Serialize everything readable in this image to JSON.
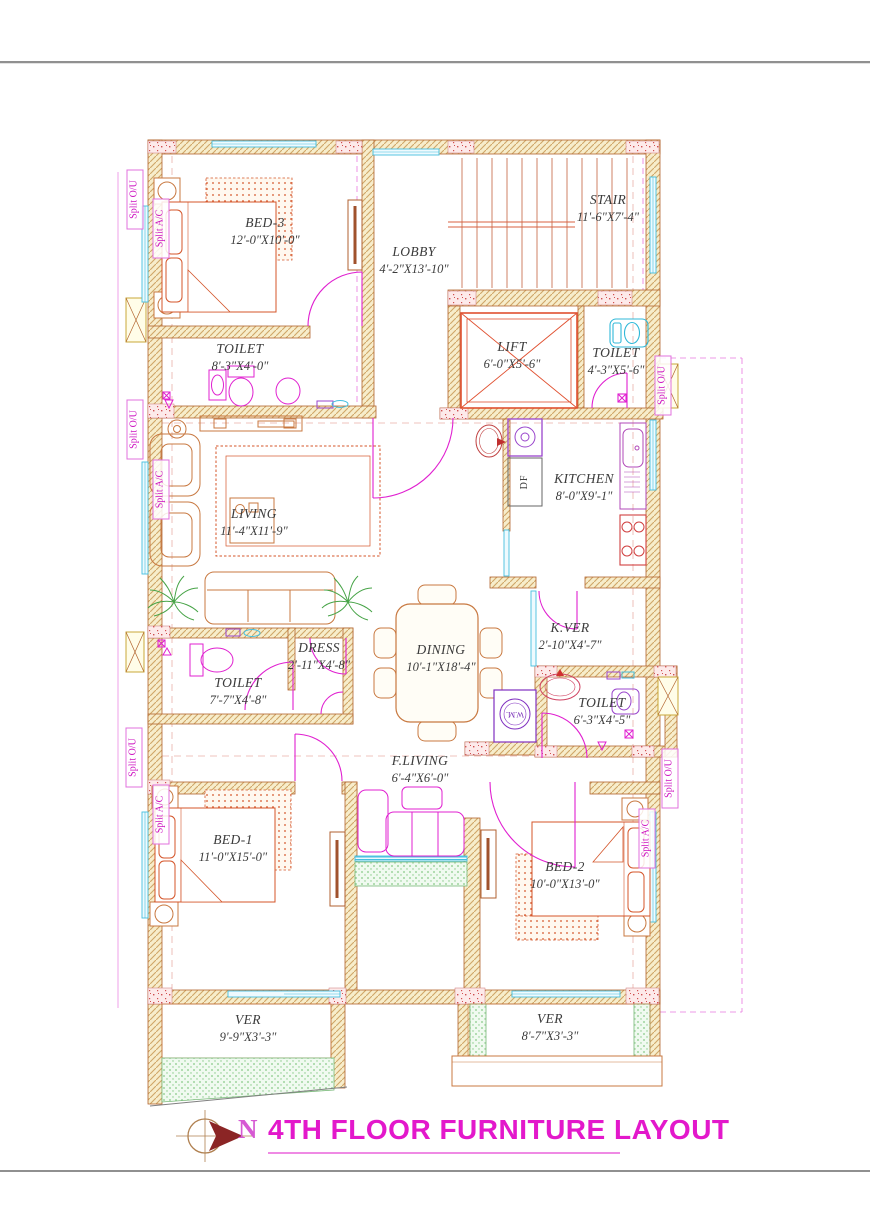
{
  "title": "4TH FLOOR FURNITURE LAYOUT",
  "north_label": "N",
  "rooms": {
    "bed3": {
      "name": "BED-3",
      "dims": "12'-0\"X10'-0\""
    },
    "toilet_bed3": {
      "name": "TOILET",
      "dims": "8'-3\"X4'-0\""
    },
    "lobby": {
      "name": "LOBBY",
      "dims": "4'-2\"X13'-10\""
    },
    "stair": {
      "name": "STAIR",
      "dims": "11'-6\"X7'-4\""
    },
    "lift": {
      "name": "LIFT",
      "dims": "6'-0\"X5'-6\""
    },
    "toilet_top": {
      "name": "TOILET",
      "dims": "4'-3\"X5'-6\""
    },
    "living": {
      "name": "LIVING",
      "dims": "11'-4\"X11'-9\""
    },
    "kitchen": {
      "name": "KITCHEN",
      "dims": "8'-0\"X9'-1\""
    },
    "kver": {
      "name": "K.VER",
      "dims": "2'-10\"X4'-7\""
    },
    "dining": {
      "name": "DINING",
      "dims": "10'-1\"X18'-4\""
    },
    "dress": {
      "name": "DRESS",
      "dims": "2'-11\"X4'-8\""
    },
    "toilet_mid": {
      "name": "TOILET",
      "dims": "7'-7\"X4'-8\""
    },
    "toilet_br": {
      "name": "TOILET",
      "dims": "6'-3\"X4'-5\""
    },
    "fliving": {
      "name": "F.LIVING",
      "dims": "6'-4\"X6'-0\""
    },
    "bed1": {
      "name": "BED-1",
      "dims": "11'-0\"X15'-0\""
    },
    "bed2": {
      "name": "BED-2",
      "dims": "10'-0\"X13'-0\""
    },
    "ver_left": {
      "name": "VER",
      "dims": "9'-9\"X3'-3\""
    },
    "ver_right": {
      "name": "VER",
      "dims": "8'-7\"X3'-3\""
    }
  },
  "annotations": {
    "df": "DF",
    "wm": "W.M."
  },
  "hvac": {
    "split_ou": "Split O/U",
    "split_ac": "Split A/C"
  },
  "colors": {
    "wall_hatch": "#cfa668",
    "wall_outline": "#b2652f",
    "furniture": "#c87840",
    "bed_accent": "#d4552a",
    "fixture_magenta": "#e020d0",
    "window_cyan": "#45bede",
    "plant_green": "#46a346",
    "title_magenta": "#e318cb"
  }
}
